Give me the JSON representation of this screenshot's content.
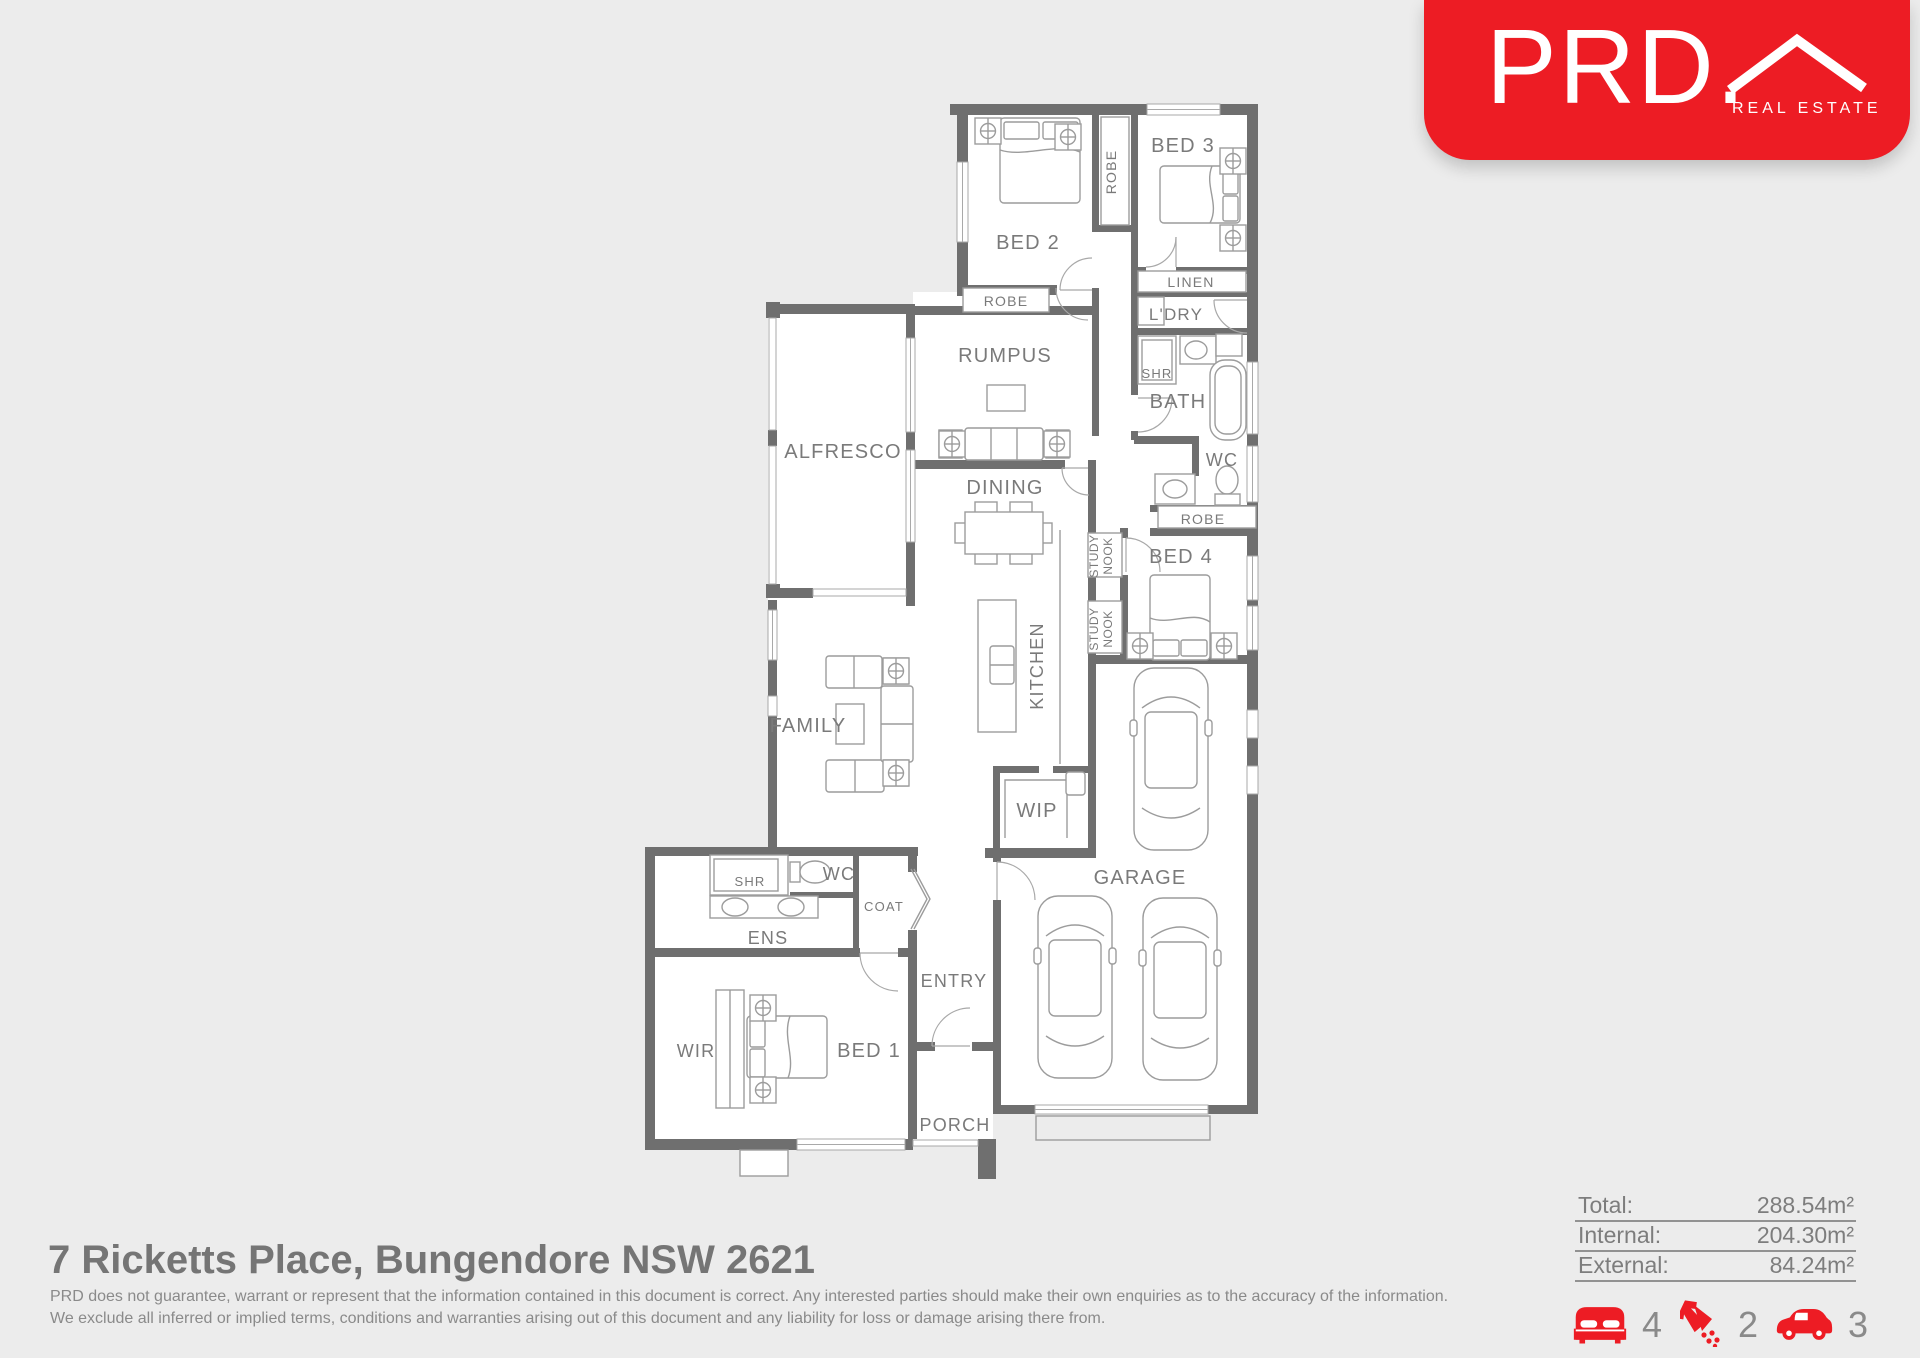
{
  "logo": {
    "brand": "PRD.",
    "tagline": "REAL ESTATE"
  },
  "plan": {
    "rooms": {
      "bed2": "BED 2",
      "bed3": "BED 3",
      "robe": "ROBE",
      "linen": "LINEN",
      "ldry": "L'DRY",
      "rumpus": "RUMPUS",
      "shr": "SHR",
      "bath": "BATH",
      "alfresco": "ALFRESCO",
      "wc": "WC",
      "dining": "DINING",
      "bed4": "BED 4",
      "study": "STUDY",
      "nook": "NOOK",
      "kitchen": "KITCHEN",
      "family": "FAMILY",
      "wip": "WIP",
      "garage": "GARAGE",
      "coat": "COAT",
      "ens": "ENS",
      "entry": "ENTRY",
      "wir": "WIR",
      "bed1": "BED 1",
      "porch": "PORCH"
    }
  },
  "footer": {
    "address": "7 Ricketts Place, Bungendore NSW 2621",
    "disclaimer1": "PRD does not guarantee, warrant or represent that the information contained in this document is correct. Any interested parties should make their own enquiries as to the accuracy of the information.",
    "disclaimer2": "We exclude all inferred or implied terms, conditions and warranties arising out of this document and any liability for loss or damage arising there from."
  },
  "areas": {
    "total_label": "Total:",
    "total_value": "288.54m²",
    "internal_label": "Internal:",
    "internal_value": "204.30m²",
    "external_label": "External:",
    "external_value": "84.24m²"
  },
  "features": {
    "beds": "4",
    "showers": "2",
    "cars": "3"
  },
  "colors": {
    "brand_red": "#ed1c24"
  }
}
